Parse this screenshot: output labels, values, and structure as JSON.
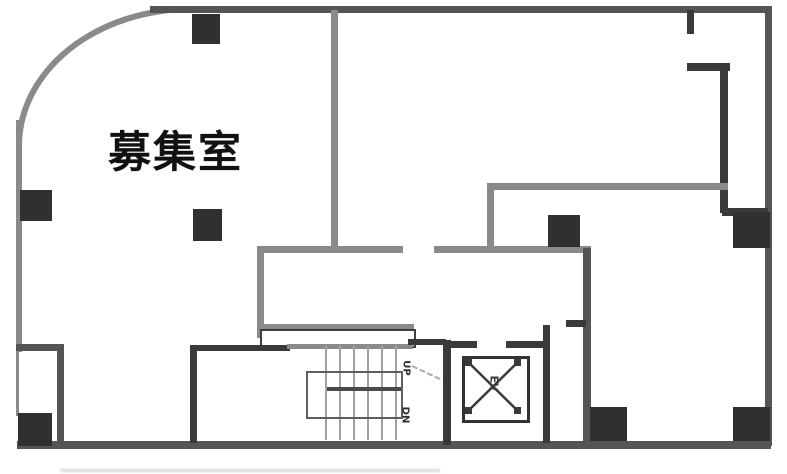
{
  "floorplan": {
    "room_label": "募集室",
    "stairs": {
      "up": "UP",
      "dn": "DN"
    },
    "elevator": "EV",
    "colors": {
      "bg": "#ffffff",
      "wall-gray": "#8a8a8a",
      "wall-mid": "#555555",
      "wall-dark": "#3a3a3a",
      "pillar": "#303030",
      "tread": "#a0a0a0",
      "ink": "#111111"
    }
  }
}
